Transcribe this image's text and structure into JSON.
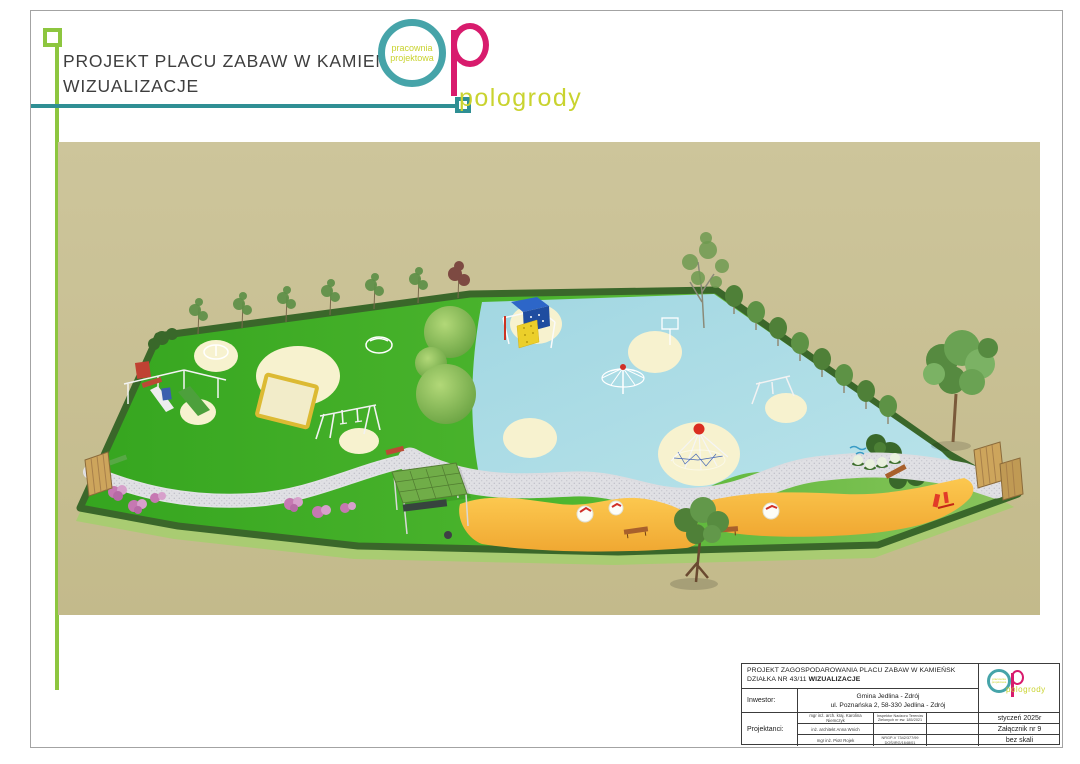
{
  "header": {
    "title_line1": "PROJEKT PLACU ZABAW W KAMIEŃSKU",
    "title_line2": "WIZUALIZACJE"
  },
  "logo": {
    "studio_line1": "pracownia",
    "studio_line2": "projektowa",
    "wordmark": "pologrody"
  },
  "title_block": {
    "project_line1": "PROJEKT ZAGOSPODAROWANIA PLACU ZABAW W KAMIEŃSK",
    "plot_label": "DZIAŁKA NR 43/11 ",
    "plot_bold": "WIZUALIZACJE",
    "investor_label": "Inwestor:",
    "investor_name": "Gmina Jedlina - Zdrój",
    "investor_address": "ul. Poznańska 2, 58-330  Jedlina - Zdrój",
    "designers_label": "Projektanci:",
    "designers": [
      {
        "name": "mgr inż. arch. kraj. Karolina Niemczyk",
        "credentials": "Inspektor Nadzoru Terenów Zielonych nr ew. 185/2021"
      },
      {
        "name": "inż. architekt Anna Wnich",
        "credentials": ""
      },
      {
        "name": "mgr inż. Piotr Rojek",
        "credentials": "NRGP-V 7342/377/99 DOŚ/IRG/1648/01"
      }
    ],
    "date": "styczeń 2025r",
    "attachment": "Załącznik nr 9",
    "scale": "bez skali"
  },
  "colors": {
    "accent_teal": "#2f8f94",
    "accent_teal_logo": "#46a4a9",
    "accent_lime": "#8dc63f",
    "accent_magenta": "#d81b6d",
    "accent_yellow_green": "#c9d32f",
    "render_background_tan": "#c8bf92",
    "render_grass_green": "#3fae24",
    "render_rubber_blue": "#a6dae4",
    "render_sand_orange": "#f8ba3f",
    "render_path_grey": "#dedee2",
    "render_hedge_green": "#3a672a",
    "render_mound_cream": "#f7f2cf"
  }
}
